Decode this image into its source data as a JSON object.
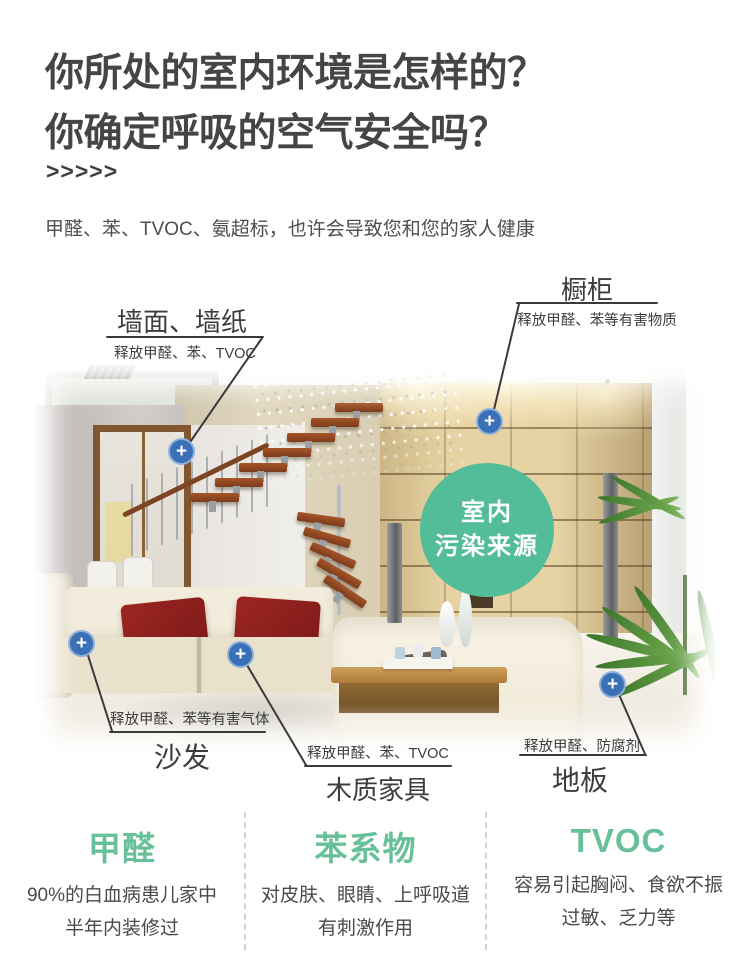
{
  "header": {
    "title_line1": "你所处的室内环境是怎样的？",
    "title_line2": "你确定呼吸的空气安全吗？",
    "chevrons": ">>>>>",
    "subtitle": "甲醛、苯、TVOC、氨超标，也许会导致您和您的家人健康"
  },
  "scene": {
    "badge": {
      "line1": "室内",
      "line2": "污染来源"
    },
    "marker_glyph": "+",
    "callouts": {
      "wall": {
        "name": "墙面、墙纸",
        "desc": "释放甲醛、苯、TVOC"
      },
      "cabinet": {
        "name": "橱柜",
        "desc": "释放甲醛、苯等有害物质"
      },
      "sofa": {
        "name": "沙发",
        "desc": "释放甲醛、苯等有害气体"
      },
      "furniture": {
        "name": "木质家具",
        "desc": "释放甲醛、苯、TVOC"
      },
      "floor": {
        "name": "地板",
        "desc": "释放甲醛、防腐剂"
      }
    }
  },
  "pollutants": [
    {
      "title": "甲醛",
      "line1": "90%的白血病患儿家中",
      "line2": "半年内装修过"
    },
    {
      "title": "苯系物",
      "line1": "对皮肤、眼睛、上呼吸道",
      "line2": "有刺激作用"
    },
    {
      "title": "TVOC",
      "line1": "容易引起胸闷、食欲不振",
      "line2": "过敏、乏力等"
    }
  ],
  "colors": {
    "accent_green": "#68c09a",
    "badge_green": "#53bd9a",
    "marker_blue": "#3a70b6",
    "title_gray": "#454545",
    "callout_line": "#3a3a3a"
  }
}
